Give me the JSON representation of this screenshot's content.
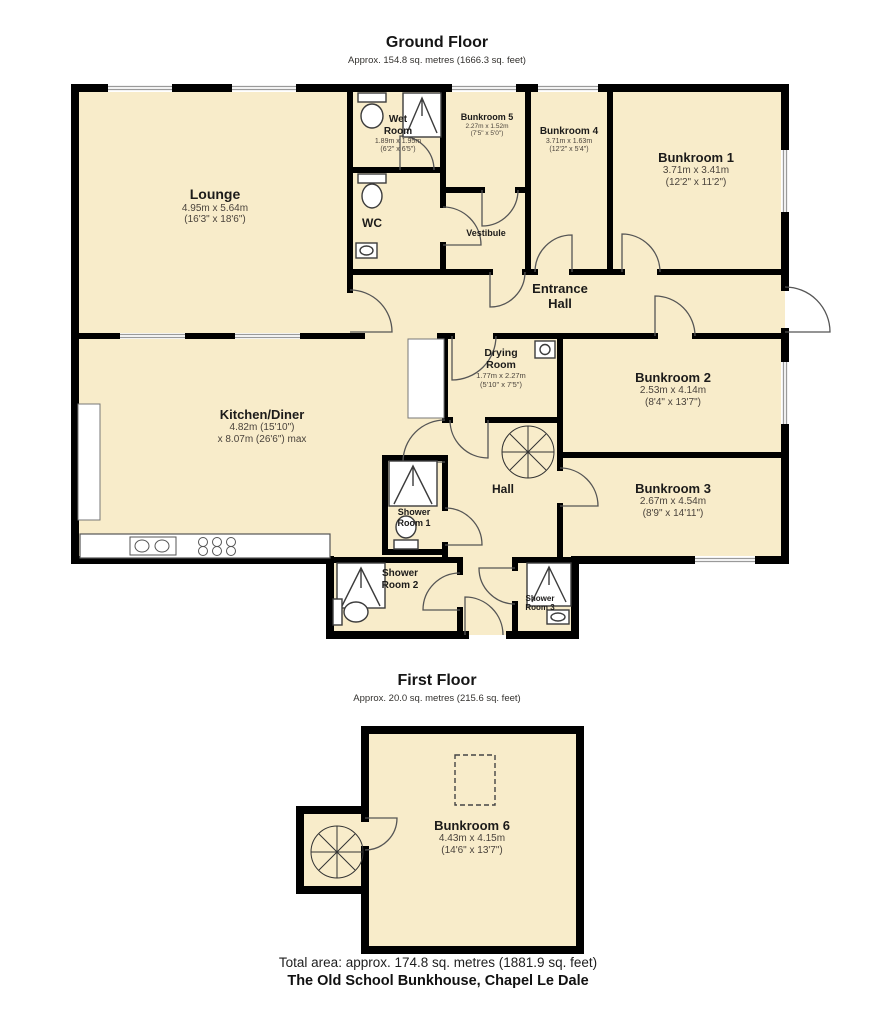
{
  "ground_floor": {
    "title": "Ground Floor",
    "subtitle": "Approx. 154.8 sq. metres (1666.3 sq. feet)"
  },
  "first_floor": {
    "title": "First Floor",
    "subtitle": "Approx. 20.0 sq. metres (215.6 sq. feet)"
  },
  "rooms": {
    "lounge": {
      "name": "Lounge",
      "metric": "4.95m x 5.64m",
      "imperial": "(16'3\" x 18'6\")"
    },
    "wet_room": {
      "name": "Wet Room",
      "metric": "1.89m x 1.95m",
      "imperial": "(6'2\" x 6'5\")"
    },
    "wc": {
      "name": "WC"
    },
    "bunkroom_5": {
      "name": "Bunkroom 5",
      "metric": "2.27m x 1.52m",
      "imperial": "(7'5\" x 5'0\")"
    },
    "bunkroom_4": {
      "name": "Bunkroom 4",
      "metric": "3.71m x 1.63m",
      "imperial": "(12'2\" x 5'4\")"
    },
    "bunkroom_1": {
      "name": "Bunkroom 1",
      "metric": "3.71m x 3.41m",
      "imperial": "(12'2\" x 11'2\")"
    },
    "vestibule": {
      "name": "Vestibule"
    },
    "entrance_hall": {
      "name": "Entrance Hall"
    },
    "drying_room": {
      "name": "Drying Room",
      "metric": "1.77m x 2.27m",
      "imperial": "(5'10\" x 7'5\")"
    },
    "bunkroom_2": {
      "name": "Bunkroom 2",
      "metric": "2.53m x 4.14m",
      "imperial": "(8'4\" x 13'7\")"
    },
    "kitchen_diner": {
      "name": "Kitchen/Diner",
      "metric": "4.82m (15'10\")",
      "imperial": "x 8.07m (26'6\") max"
    },
    "bunkroom_3": {
      "name": "Bunkroom 3",
      "metric": "2.67m x 4.54m",
      "imperial": "(8'9\" x 14'11\")"
    },
    "hall": {
      "name": "Hall"
    },
    "shower_room_1": {
      "name": "Shower Room 1"
    },
    "shower_room_2": {
      "name": "Shower Room 2"
    },
    "shower_room_3": {
      "name": "Shower Room 3"
    },
    "bunkroom_6": {
      "name": "Bunkroom 6",
      "metric": "4.43m x 4.15m",
      "imperial": "(14'6\" x 13'7\")"
    }
  },
  "footer": {
    "total_area": "Total area: approx. 174.8 sq. metres (1881.9 sq. feet)",
    "property_name": "The Old School Bunkhouse, Chapel Le Dale"
  },
  "colors": {
    "room_fill": "#f8ecca",
    "wall": "#000000",
    "window": "#9a9a9a",
    "door_arc": "#555555"
  }
}
